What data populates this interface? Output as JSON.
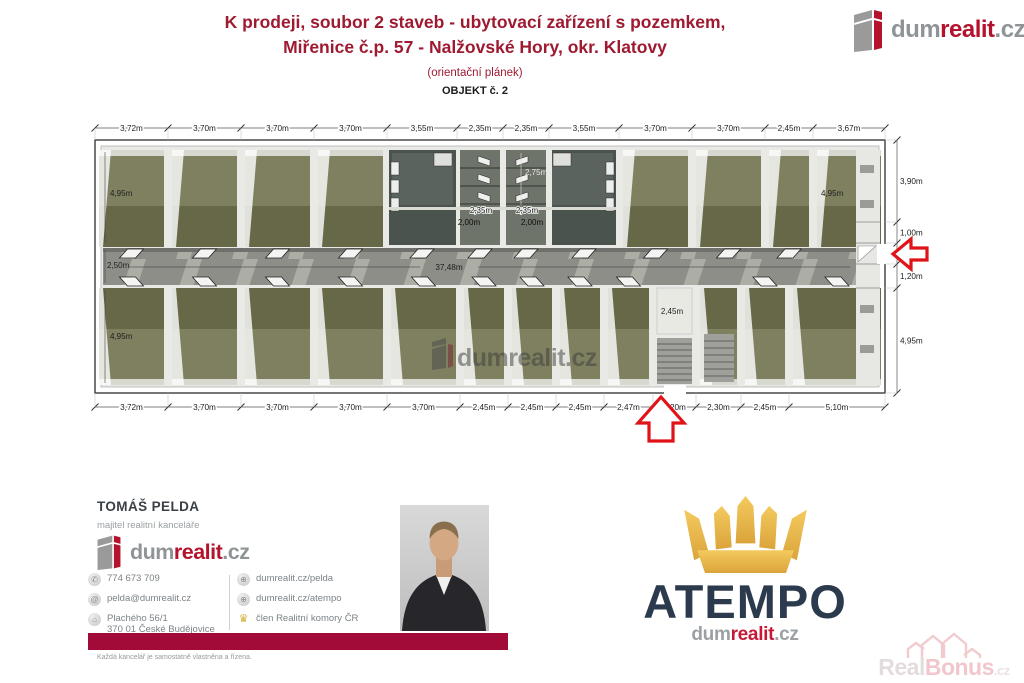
{
  "header": {
    "title_line1": "K prodeji, soubor 2 staveb - ubytovací zařízení s pozemkem,",
    "title_line2": "Miřenice č.p. 57 - Nalžovské Hory, okr. Klatovy",
    "subtitle": "(orientační plánek)",
    "object_label": "OBJEKT č. 2"
  },
  "logo": {
    "dum": "dum",
    "realit": "realit",
    "cz": ".cz"
  },
  "floorplan": {
    "watermark": "dumrealit.cz",
    "corridor_length_label": "37,48m",
    "top_dims": [
      "3,72m",
      "3,70m",
      "3,70m",
      "3,70m",
      "3,55m",
      "2,35m",
      "2,35m",
      "3,55m",
      "3,70m",
      "3,70m",
      "2,45m",
      "3,67m"
    ],
    "bottom_dims": [
      "3,72m",
      "3,70m",
      "3,70m",
      "3,70m",
      "3,70m",
      "2,45m",
      "2,45m",
      "2,45m",
      "2,47m",
      "2,20m",
      "2,30m",
      "2,45m",
      "5,10m"
    ],
    "right_dims": [
      "3,90m",
      "1,00m",
      "1,25m",
      "1,20m",
      "4,95m"
    ],
    "interior": {
      "left_top": "4,95m",
      "left_corridor": "2,50m",
      "left_bottom": "4,95m",
      "san_height": "2,75m",
      "san_w1": "2,35m",
      "san_w2": "2,35m",
      "san_d1": "2,00m",
      "san_d2": "2,00m",
      "vestibule": "2,45m",
      "right_room": "4,95m"
    }
  },
  "contact": {
    "name": "TOMÁŠ PELDA",
    "role": "majitel realitní kanceláře",
    "phone": "774 673 709",
    "email": "pelda@dumrealit.cz",
    "address_line1": "Plachého 56/1",
    "address_line2": "370 01 České Budějovice",
    "web1": "dumrealit.cz/pelda",
    "web2": "dumrealit.cz/atempo",
    "membership": "člen Realitní komory ČR",
    "disclaimer": "Každá kancelář je samostatně vlastněna a řízena."
  },
  "atempo": {
    "name": "ATEMPO",
    "sub_dum": "dum",
    "sub_realit": "realit",
    "sub_cz": ".cz"
  },
  "realbonus": {
    "real": "Real",
    "bonus": "Bonus",
    "cz": ".cz"
  },
  "colors": {
    "brand_red": "#b5122d",
    "brand_gray": "#8f9496",
    "title_red": "#9e1a31",
    "bar_red": "#a20a38",
    "navy": "#2b3a4d",
    "gold": "#e9bc4e",
    "arrow_red": "#e01319",
    "room_olive": "#666847",
    "corridor_gray": "#8d8e88"
  }
}
